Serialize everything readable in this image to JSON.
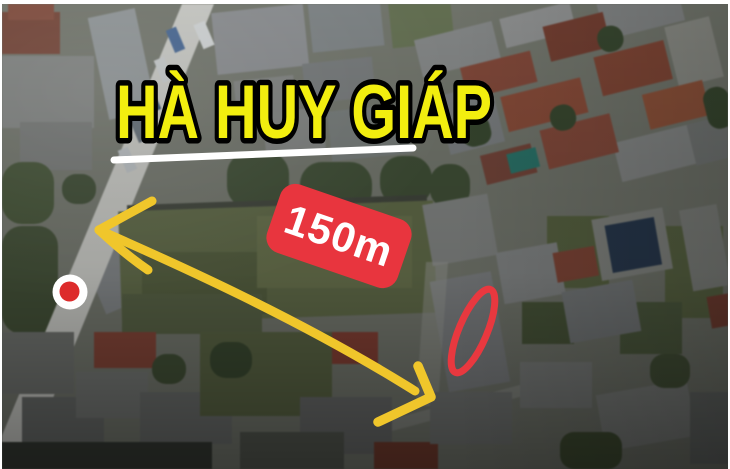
{
  "title": {
    "text": "HÀ HUY GIÁP",
    "color": "#f2ee0f",
    "outline": "#000000"
  },
  "distance_badge": {
    "label": "150m",
    "bg": "#e8353e",
    "text_color": "#ffffff"
  },
  "annotations": {
    "underline_color": "#ffffff",
    "arrow_color": "#f0c62b",
    "highlight_ellipse_color": "#e8383f",
    "pin": {
      "icon": "location-pin",
      "outer": "#ffffff",
      "inner": "#dd2b2b"
    }
  }
}
